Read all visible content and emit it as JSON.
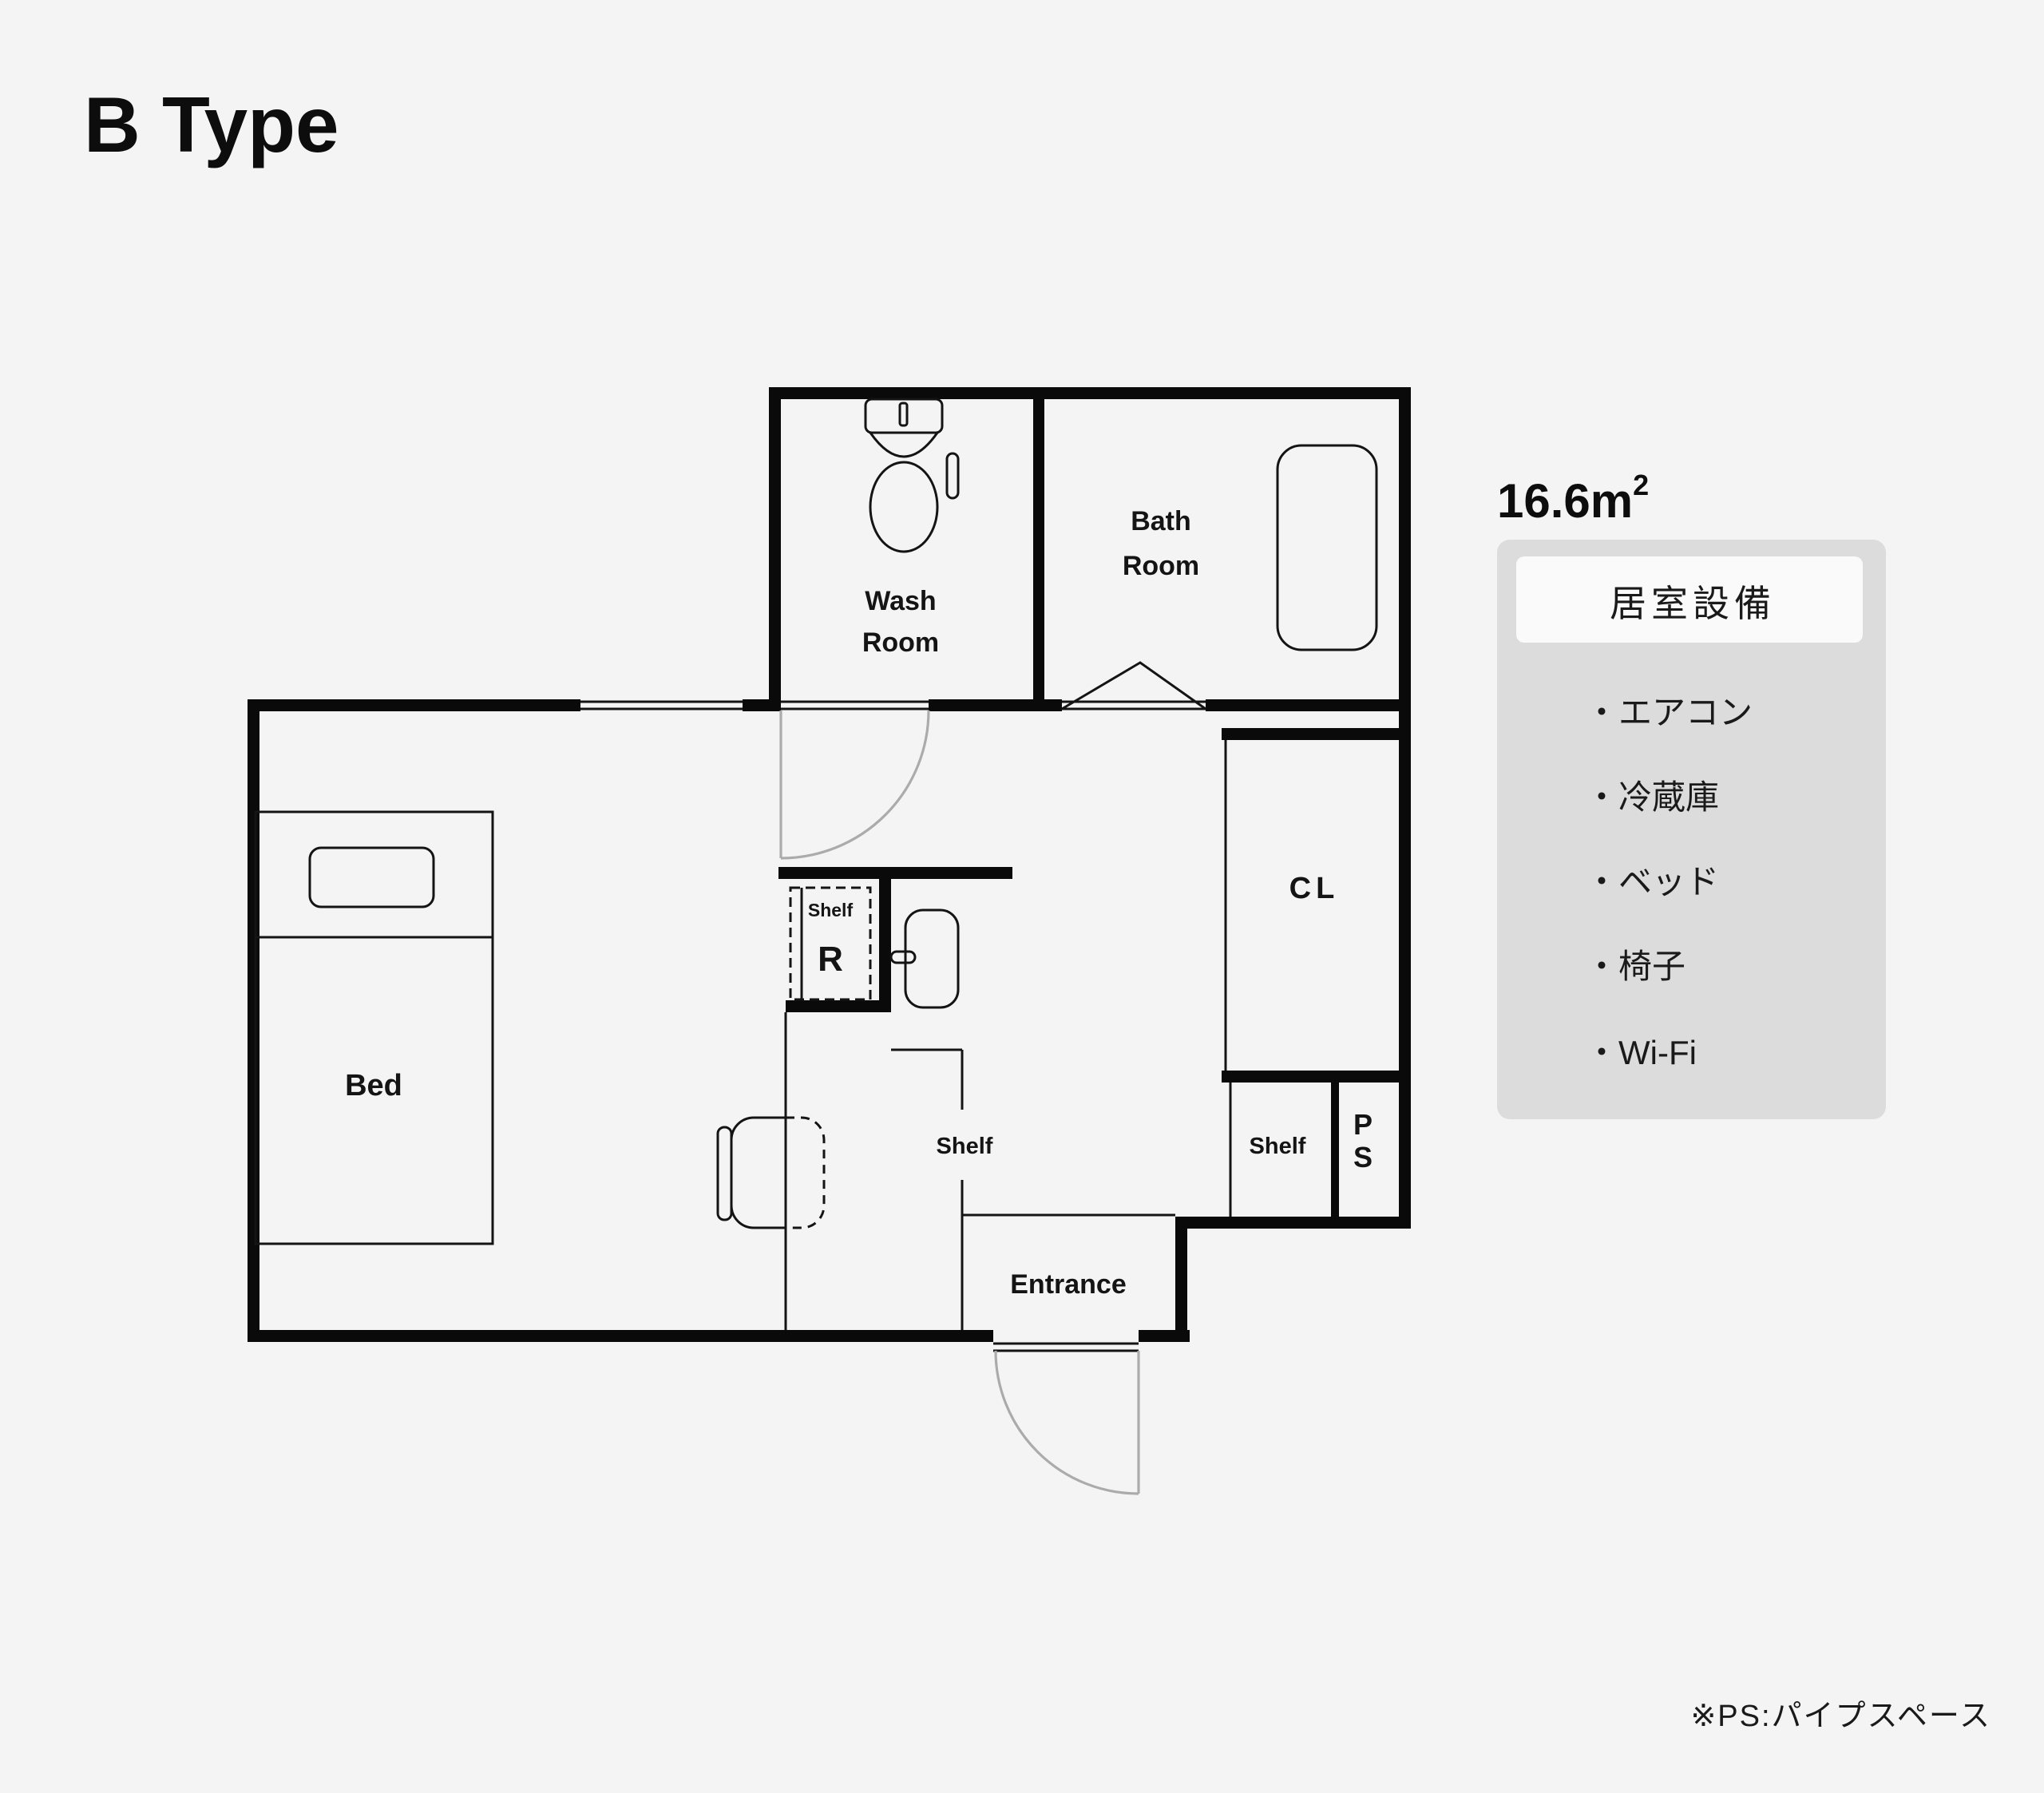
{
  "page": {
    "title": "B Type",
    "background_color": "#f4f4f4"
  },
  "plan": {
    "area_value": "16.6m",
    "area_sup": "2",
    "colors": {
      "wall": "#0a0a0a",
      "thin_line": "#141414",
      "door_arc": "#ababab"
    },
    "rooms": {
      "wash_line1": "Wash",
      "wash_line2": "Room",
      "bath_line1": "Bath",
      "bath_line2": "Room",
      "closet": "CL",
      "bed": "Bed",
      "entrance": "Entrance",
      "fridge_shelf_label": "Shelf",
      "fridge_letter": "R",
      "hall_shelf_label": "Shelf",
      "closet_shelf_label": "Shelf",
      "pipe_space_line1": "P",
      "pipe_space_line2": "S"
    }
  },
  "equipment": {
    "header": "居室設備",
    "items": [
      "・エアコン",
      "・冷蔵庫",
      "・ベッド",
      "・椅子",
      "・Wi-Fi"
    ],
    "panel_color": "#dcdcdc",
    "header_bg_color": "#fafafa"
  },
  "footer": {
    "note": "※PS:パイプスペース"
  }
}
